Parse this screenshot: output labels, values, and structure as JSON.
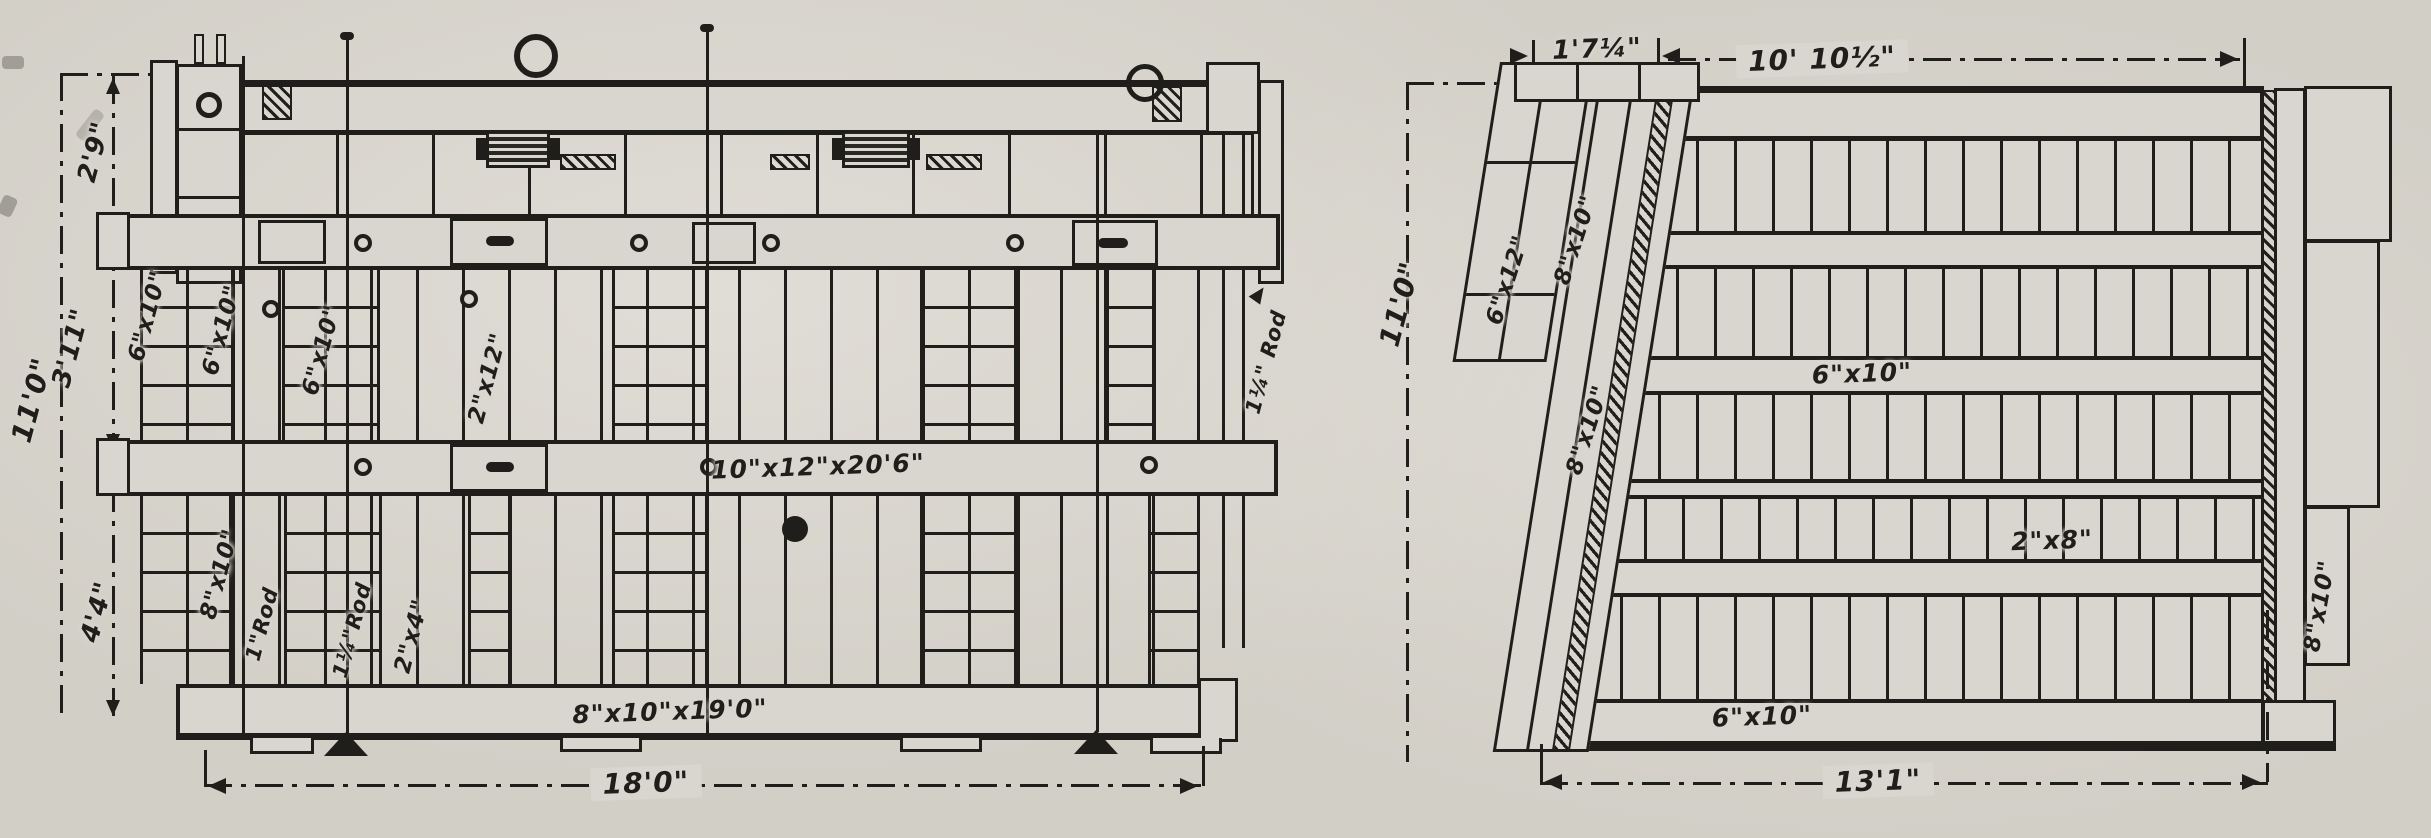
{
  "colors": {
    "paper": "#d9d6cf",
    "ink": "#201e1a"
  },
  "left_view": {
    "dims": {
      "overall_height": "11'0\"",
      "segment_top": "2'9\"",
      "segment_middle": "3'11\"",
      "segment_bottom": "4'4\"",
      "overall_width": "18'0\""
    },
    "parts": {
      "post_left_1": "6\"x10\"",
      "post_left_2": "6\"x10\"",
      "post_left_3": "6\"x10\"",
      "plank": "2\"x12\"",
      "top_waler": "10\"x12\"x20'6\"",
      "sill": "8\"x10\"x19'0\"",
      "post_lower": "8\"x10\"",
      "rod_small": "1\"Rod",
      "rod_large": "1¼\"Rod",
      "brace": "2\"x4\"",
      "rod_right": "1¼\" Rod"
    }
  },
  "right_view": {
    "dims": {
      "overall_height": "11'0\"",
      "top_offset": "1'7¼\"",
      "top_width": "10' 10½\"",
      "bottom_width": "13'1\""
    },
    "parts": {
      "batter_outer": "6\"x12\"",
      "batter_upper": "8\"x10\"",
      "batter_lower": "8\"x10\"",
      "mid_waler": "6\"x10\"",
      "sheathing": "2\"x8\"",
      "bottom_waler": "6\"x10\"",
      "end_post": "8\"x10\""
    }
  }
}
